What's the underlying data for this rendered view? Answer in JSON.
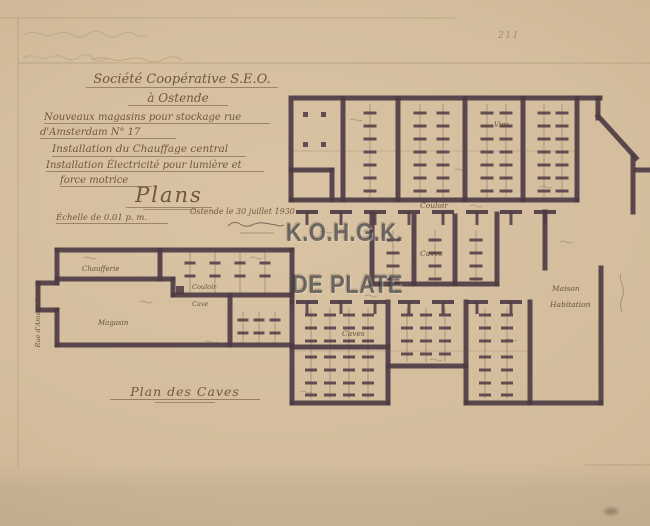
{
  "page": {
    "pencil_number": "211"
  },
  "title": {
    "line1": "Société Coopérative S.E.O.",
    "line2": "à Ostende",
    "line3": "Nouveaux magasins pour stockage rue",
    "line4": "d'Amsterdam N° 17",
    "line5": "Installation du Chauffage central",
    "line6": "Installation Électricité pour lumière et",
    "line7": "force motrice",
    "line8": "Plans",
    "scale": "Échelle de 0.01 p. m.",
    "place_date": "Ostende le 30 juillet 1930"
  },
  "caption": {
    "text": "Plan des Caves"
  },
  "watermark": {
    "line1": "K.O.H.G.K.",
    "line2": "DE PLATE",
    "color_hex": "#2c2c34"
  },
  "plan": {
    "ink_color": "#4d3a44",
    "paper_color": "#cbb492",
    "labels": {
      "street": "Rue d'Amsterdam",
      "vins": "Vins",
      "couloir": "Couloir",
      "caves_mid": "Caves",
      "caves_low": "Caves",
      "chaufferie": "Chaufferie",
      "magasin": "Magasin",
      "cave": "Cave",
      "couloir_wing": "Couloir",
      "maison": "Maison",
      "habitation": "Habitation"
    }
  }
}
